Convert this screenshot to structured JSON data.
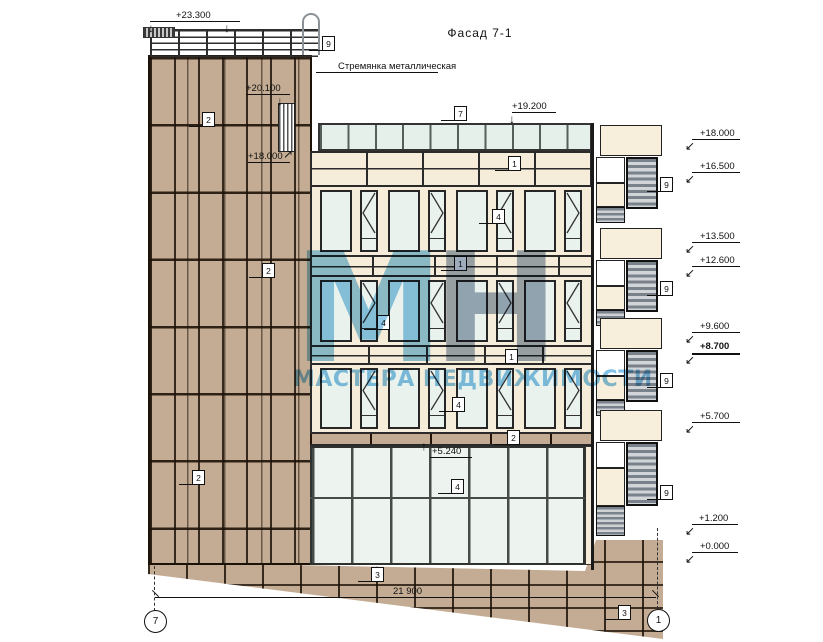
{
  "title": "Фасад 7-1",
  "notes": {
    "ladder": "Стремянка металлическая"
  },
  "watermark": {
    "letters": [
      {
        "ch": "М",
        "color": "#7cbfe3"
      },
      {
        "ch": "Н",
        "color": "#8d9db1"
      }
    ],
    "sub": "МАСТЕРА НЕДВИЖИМОСТИ"
  },
  "dimension": {
    "value": "21 900"
  },
  "axes": [
    {
      "label": "7",
      "cx": 155,
      "cy": 621
    },
    {
      "label": "1",
      "cx": 658,
      "cy": 620
    }
  ],
  "colors": {
    "stone": "#c3ac93",
    "panel_cream": "#f5ecd9",
    "glass": "#e9f2ed",
    "louver_dark": "#79818a",
    "watermark_blue": "#7cbfe3"
  },
  "elevations": [
    {
      "text": "+23.300",
      "tx": 176,
      "ty": 10,
      "line": {
        "x": 150,
        "y": 21,
        "w": 90
      },
      "arrows": [
        {
          "ch": "↓",
          "x": 148,
          "y": 23
        },
        {
          "ch": "↓",
          "x": 224,
          "y": 23
        }
      ]
    },
    {
      "text": "+20.100",
      "tx": 246,
      "ty": 83,
      "line": {
        "x": 246,
        "y": 94,
        "w": 44
      },
      "arrows": [
        {
          "ch": "↓",
          "x": 277,
          "y": 96
        }
      ]
    },
    {
      "text": "+18.000",
      "tx": 248,
      "ty": 151,
      "line": {
        "x": 248,
        "y": 162,
        "w": 42
      },
      "arrows": [
        {
          "ch": "↗",
          "x": 283,
          "y": 149
        }
      ]
    },
    {
      "text": "+19.200",
      "tx": 512,
      "ty": 101,
      "line": {
        "x": 512,
        "y": 112,
        "w": 44
      },
      "arrows": [
        {
          "ch": "↓",
          "x": 509,
          "y": 114
        }
      ]
    },
    {
      "text": "+5.240",
      "tx": 432,
      "ty": 446,
      "line": {
        "x": 430,
        "y": 457,
        "w": 42
      },
      "arrows": [
        {
          "ch": "↑",
          "x": 421,
          "y": 441
        }
      ]
    },
    {
      "text": "+18.000",
      "tx": 700,
      "ty": 128,
      "line": {
        "x": 692,
        "y": 139,
        "w": 48
      },
      "arrows": [
        {
          "ch": "↙",
          "x": 685,
          "y": 141
        }
      ]
    },
    {
      "text": "+16.500",
      "tx": 700,
      "ty": 161,
      "line": {
        "x": 692,
        "y": 172,
        "w": 48
      },
      "arrows": [
        {
          "ch": "↙",
          "x": 685,
          "y": 174
        }
      ]
    },
    {
      "text": "+13.500",
      "tx": 700,
      "ty": 231,
      "line": {
        "x": 692,
        "y": 242,
        "w": 48
      },
      "arrows": [
        {
          "ch": "↙",
          "x": 685,
          "y": 244
        }
      ]
    },
    {
      "text": "+12.600",
      "tx": 700,
      "ty": 255,
      "line": {
        "x": 692,
        "y": 266,
        "w": 48
      },
      "arrows": [
        {
          "ch": "↙",
          "x": 685,
          "y": 268
        }
      ]
    },
    {
      "text": "+9.600",
      "tx": 700,
      "ty": 321,
      "line": {
        "x": 692,
        "y": 332,
        "w": 48
      },
      "arrows": [
        {
          "ch": "↙",
          "x": 685,
          "y": 334
        }
      ]
    },
    {
      "text": "+8.700",
      "tx": 700,
      "ty": 341,
      "bold": true,
      "line": {
        "x": 692,
        "y": 353,
        "w": 48
      },
      "arrows": [
        {
          "ch": "↙",
          "x": 685,
          "y": 355
        }
      ]
    },
    {
      "text": "+5.700",
      "tx": 700,
      "ty": 411,
      "line": {
        "x": 692,
        "y": 422,
        "w": 48
      },
      "arrows": [
        {
          "ch": "↙",
          "x": 685,
          "y": 424
        }
      ]
    },
    {
      "text": "+1.200",
      "tx": 699,
      "ty": 513,
      "line": {
        "x": 692,
        "y": 524,
        "w": 46
      },
      "arrows": [
        {
          "ch": "↙",
          "x": 685,
          "y": 526
        }
      ]
    },
    {
      "text": "+0.000",
      "tx": 700,
      "ty": 541,
      "line": {
        "x": 692,
        "y": 552,
        "w": 46
      },
      "arrows": [
        {
          "ch": "↙",
          "x": 685,
          "y": 554
        }
      ]
    }
  ],
  "callouts": [
    {
      "n": "9",
      "x": 322,
      "y": 36
    },
    {
      "n": "2",
      "x": 202,
      "y": 112
    },
    {
      "n": "7",
      "x": 454,
      "y": 106
    },
    {
      "n": "1",
      "x": 508,
      "y": 156
    },
    {
      "n": "4",
      "x": 492,
      "y": 209
    },
    {
      "n": "1",
      "x": 454,
      "y": 256
    },
    {
      "n": "2",
      "x": 262,
      "y": 263
    },
    {
      "n": "4",
      "x": 377,
      "y": 315
    },
    {
      "n": "1",
      "x": 505,
      "y": 349
    },
    {
      "n": "4",
      "x": 452,
      "y": 397
    },
    {
      "n": "2",
      "x": 507,
      "y": 430
    },
    {
      "n": "2",
      "x": 192,
      "y": 470
    },
    {
      "n": "4",
      "x": 451,
      "y": 479
    },
    {
      "n": "3",
      "x": 371,
      "y": 567
    },
    {
      "n": "3",
      "x": 618,
      "y": 605
    },
    {
      "n": "9",
      "x": 660,
      "y": 177
    },
    {
      "n": "9",
      "x": 660,
      "y": 281
    },
    {
      "n": "9",
      "x": 660,
      "y": 373
    },
    {
      "n": "9",
      "x": 660,
      "y": 485
    }
  ]
}
